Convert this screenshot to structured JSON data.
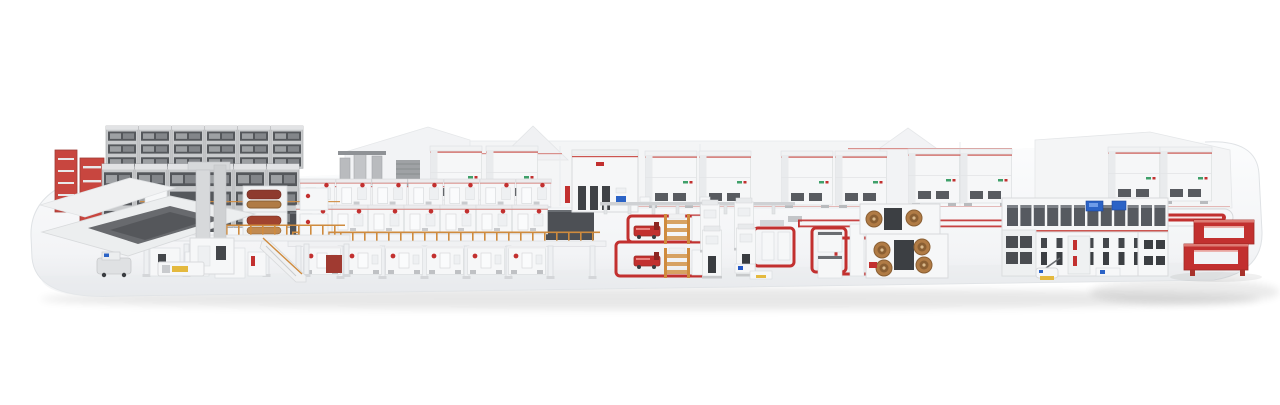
{
  "scene": {
    "type": "isometric-3d-render",
    "subject": "complete-industrial-production-line-on-white-platform",
    "sections": [
      {
        "id": "platform-base",
        "name": "rounded white display platform"
      },
      {
        "id": "raw-material-storage-racks",
        "name": "gray pallet racks with red rack towers"
      },
      {
        "id": "agv-robot",
        "name": "small AGV shuttle at left"
      },
      {
        "id": "unwinding-splicing-table",
        "name": "flat splicing table with dark web"
      },
      {
        "id": "wet-end-mezzanine",
        "name": "orange-railed mezzanine with red and copper rolls"
      },
      {
        "id": "drying-oven-line",
        "name": "long repeated white oven modules on elevated deck"
      },
      {
        "id": "mixing-station",
        "name": "gray piping and towers"
      },
      {
        "id": "batching-tower",
        "name": "tall white cabinet with colored panels"
      },
      {
        "id": "background-hoppers",
        "name": "paired white hopper cabinets with red trim"
      },
      {
        "id": "transfer-conveyor",
        "name": "low gray conveyor and red twin-line track"
      },
      {
        "id": "agv-loop-area",
        "name": "red floor loops with red shuttles and wooden pallet stations"
      },
      {
        "id": "winding-towers",
        "name": "white tower machines inside loops"
      },
      {
        "id": "slitting-machines",
        "name": "machines with copper foil coils"
      },
      {
        "id": "final-assembly-line",
        "name": "glass-fronted line with blue HMI screens"
      },
      {
        "id": "elevated-return-conveyor",
        "name": "red racetrack frames and red-striped pill conveyor"
      },
      {
        "id": "floor-scrubber-robot",
        "name": "small yellow-pad cleaning robot"
      }
    ]
  },
  "palette": {
    "bg": "#ffffff",
    "platform_top": "#fbfcfd",
    "platform_bottom": "#e7e9ec",
    "platform_edge": "#dfe2e5",
    "machine_white": "#f6f7f8",
    "machine_edge": "#d8dadc",
    "machine_shade": "#e9ebed",
    "accent_red": "#c2302f",
    "trim_red": "#d98c88",
    "dark_red": "#9e2a24",
    "orange": "#cf8b3e",
    "wood": "#d7a263",
    "copper": "#b07b45",
    "copper_dark": "#8a5f33",
    "copper_light": "#d9b98c",
    "rack_gray": "#c9cbcd",
    "slot_dark": "#4a4d52",
    "glass_dark": "#565a60",
    "screen_blue": "#2b63c6",
    "safety_yellow": "#e4b93e",
    "green_chip": "#3fa06a",
    "shadow": "rgba(60,65,70,0.10)"
  },
  "counts": {
    "oven_modules_row_top": 7,
    "oven_modules_row_mid": 7,
    "oven_modules_ground": 6,
    "rack_bays_back": 6,
    "rack_bays_front": 6,
    "support_columns": 8,
    "mezzanine_legs": 6,
    "glass_cells": 12,
    "door_columns": 9,
    "conveyor_stands": 8,
    "walkway_posts_line": 26,
    "walkway_posts_mezz": 17
  }
}
